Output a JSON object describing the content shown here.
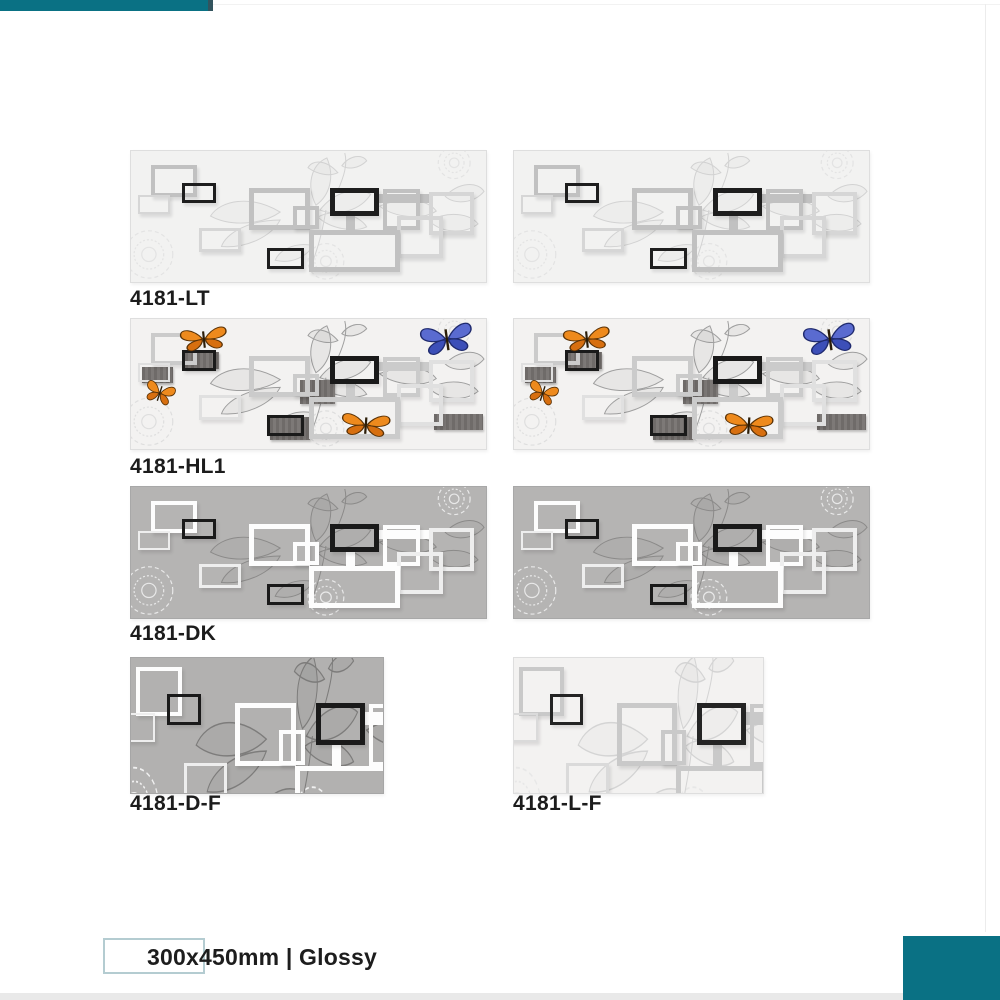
{
  "codes": {
    "lt": "4181-LT",
    "hl1": "4181-HL1",
    "dk": "4181-DK",
    "df": "4181-D-F",
    "lf": "4181-L-F"
  },
  "footer": {
    "size_label": "300x450mm | Glossy"
  },
  "colors": {
    "accent_teal": "#0a7184",
    "accent_teal_cap": "#33545e",
    "tile_light_bg": "#f2f2f1",
    "tile_dark_bg": "#b5b4b3",
    "frame_black": "#1a1a1a",
    "frame_white": "#fdfdfd",
    "butterfly_orange": "#ee8a1d",
    "butterfly_orange_dark": "#d76f10",
    "butterfly_blue": "#5a6bd0",
    "butterfly_blue_dark": "#3c4fb8"
  },
  "tile_variants": {
    "lt": {
      "bg": "#f2f2f1",
      "g1": "#c1c1c1",
      "g2": "#d6d6d6",
      "k": "#1e1e1e",
      "art": "#d2d2d2",
      "orn": "#e3e3e3",
      "solids": null,
      "butterflies": false,
      "crop": false,
      "border": "#dedede"
    },
    "hl1": {
      "bg": "#f3f2f1",
      "g1": "#cbcbcb",
      "g2": "#e0e0e0",
      "k": "#1a1a1a",
      "art": "#9e9e9e",
      "orn": "#dedede",
      "solids": "#6f6b69",
      "butterflies": true,
      "crop": false,
      "border": "#dedede"
    },
    "dk": {
      "bg": "#b5b4b3",
      "g1": "#fdfdfd",
      "g2": "#eeeeee",
      "k": "#1a1a1a",
      "art": "#8b8a89",
      "orn": "#e9e9e9",
      "solids": null,
      "butterflies": false,
      "crop": false,
      "border": "#a8a8a8"
    },
    "df": {
      "bg": "#b2b1b0",
      "g1": "#fdfdfd",
      "g2": "#eeeeee",
      "k": "#1a1a1a",
      "art": "#7d7c7b",
      "orn": "#f0f0f0",
      "solids": null,
      "butterflies": false,
      "crop": true,
      "border": "#a6a6a6"
    },
    "lf": {
      "bg": "#f3f2f1",
      "g1": "#c9c9c9",
      "g2": "#dadada",
      "k": "#242424",
      "art": "#d4d4d4",
      "orn": "#e7e7e7",
      "solids": null,
      "butterflies": false,
      "crop": true,
      "border": "#dedede"
    }
  },
  "tile_design": {
    "frames": [
      {
        "x": 20,
        "y": 14,
        "w": 46,
        "h": 33,
        "b": 4,
        "c": "g1"
      },
      {
        "x": 51,
        "y": 32,
        "w": 34,
        "h": 21,
        "b": 3,
        "c": "k"
      },
      {
        "x": 7,
        "y": 45,
        "w": 32,
        "h": 19,
        "b": 2,
        "c": "g2"
      },
      {
        "x": 119,
        "y": 38,
        "w": 61,
        "h": 42,
        "b": 5,
        "c": "g1"
      },
      {
        "x": 163,
        "y": 56,
        "w": 26,
        "h": 23,
        "b": 4,
        "c": "g1"
      },
      {
        "x": 247,
        "y": 44,
        "w": 55,
        "h": 9,
        "b": 0,
        "c": "g1"
      },
      {
        "x": 216,
        "y": 64,
        "w": 9,
        "h": 18,
        "b": 0,
        "c": "g1"
      },
      {
        "x": 200,
        "y": 38,
        "w": 49,
        "h": 28,
        "b": 5,
        "c": "k"
      },
      {
        "x": 253,
        "y": 39,
        "w": 38,
        "h": 41,
        "b": 4,
        "c": "g1"
      },
      {
        "x": 300,
        "y": 42,
        "w": 45,
        "h": 43,
        "b": 4,
        "c": "g2"
      },
      {
        "x": 268,
        "y": 66,
        "w": 46,
        "h": 43,
        "b": 4,
        "c": "g2"
      },
      {
        "x": 68,
        "y": 78,
        "w": 43,
        "h": 25,
        "b": 3,
        "c": "g2"
      },
      {
        "x": 179,
        "y": 80,
        "w": 92,
        "h": 43,
        "b": 5,
        "c": "g1"
      },
      {
        "x": 137,
        "y": 98,
        "w": 37,
        "h": 22,
        "b": 3,
        "c": "k"
      }
    ],
    "solids": [
      {
        "x": 54,
        "y": 34,
        "w": 35,
        "h": 17
      },
      {
        "x": 11,
        "y": 49,
        "w": 31,
        "h": 16
      },
      {
        "x": 170,
        "y": 62,
        "w": 35,
        "h": 25
      },
      {
        "x": 140,
        "y": 100,
        "w": 40,
        "h": 24
      },
      {
        "x": 305,
        "y": 97,
        "w": 49,
        "h": 17
      }
    ],
    "butterflies": [
      {
        "x": 46,
        "y": 6,
        "w": 54,
        "h": 28,
        "kind": "orange",
        "rot": -6
      },
      {
        "x": 12,
        "y": 62,
        "w": 34,
        "h": 26,
        "kind": "orange",
        "rot": 18
      },
      {
        "x": 208,
        "y": 94,
        "w": 56,
        "h": 28,
        "kind": "orange",
        "rot": 4
      },
      {
        "x": 288,
        "y": 2,
        "w": 60,
        "h": 36,
        "kind": "blue",
        "rot": -8
      }
    ],
    "ornaments": [
      {
        "x": 18,
        "y": 105,
        "r": 24
      },
      {
        "x": 325,
        "y": 12,
        "r": 16
      },
      {
        "x": 196,
        "y": 112,
        "r": 18
      }
    ],
    "leaf_paths": [
      {
        "d": "M215,2 C218,14 214,26 208,40",
        "open": true
      },
      {
        "d": "M208,22 C196,8 182,9 178,17 C188,24 200,26 208,22 Z"
      },
      {
        "d": "M212,15 C220,4 233,3 237,10 C229,18 218,19 212,15 Z"
      },
      {
        "d": "M150,62 C120,44 90,50 80,66 C100,77 132,75 150,62 Z"
      },
      {
        "d": "M150,70 C118,70 95,84 91,97 C116,99 141,87 150,70 Z"
      },
      {
        "d": "M186,55 C176,35 181,14 197,7 C205,26 200,45 186,55 Z"
      },
      {
        "d": "M190,60 C205,40 229,36 241,44 C231,60 208,67 190,60 Z"
      },
      {
        "d": "M188,67 C200,79 225,83 237,77 C229,64 204,58 188,67 Z"
      },
      {
        "d": "M250,56 C276,45 299,50 307,61 C292,71 264,67 250,56 Z"
      },
      {
        "d": "M196,60 C193,80 188,100 180,119",
        "open": true
      },
      {
        "d": "M183,96 C164,92 149,101 145,111 C162,115 177,107 183,96 Z"
      },
      {
        "d": "M300,71 C320,60 341,64 349,74 C335,85 312,83 300,71 Z"
      },
      {
        "d": "M316,46 C330,31 349,31 355,41 C345,53 325,55 316,46 Z"
      }
    ]
  }
}
